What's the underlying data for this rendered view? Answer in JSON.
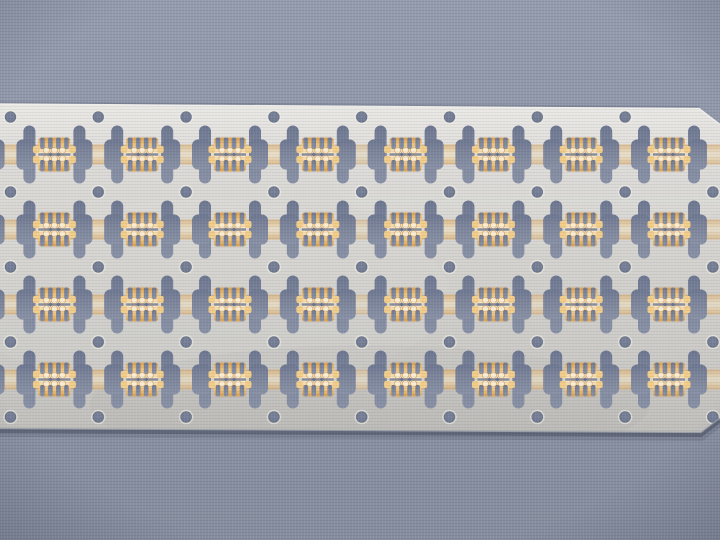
{
  "scene": {
    "description": "Photograph of an etched metal semiconductor lead frame strip with selective gold plating, lying on a blue-gray woven fabric background",
    "width": 720,
    "height": 540
  },
  "palette": {
    "bg_top": "#949cae",
    "bg_mid": "#8c94a6",
    "bg_bottom": "#858d9f",
    "metal_bright": "#eae9e5",
    "metal_hi": "#dedcd8",
    "metal_mid": "#d4d3cf",
    "metal_low": "#cac9c5",
    "metal_dark": "#c0bfbb",
    "edge_highlight": "#f2f1ed",
    "edge_shadow": "#343a4c",
    "cut_dark": "#6c7690",
    "cut_mid": "#7a8399",
    "cut_light": "#8891a5",
    "gold_deep": "#d89b4a",
    "gold_mid": "#eec584",
    "gold_pale": "#f6e7c6",
    "gold_hot": "#f9ecd2",
    "gold_tab": "#f2cd8a",
    "hole_ring": "#eef0ea"
  },
  "frame": {
    "strip": {
      "top_left_y": 104,
      "top_right_x": 699,
      "top_right_y": 108.5,
      "chamfer_top_right": [
        720,
        124.5
      ],
      "right_bottom": [
        720,
        418
      ],
      "chamfer_bottom_right": [
        701,
        432.5
      ],
      "bottom_left_y": 428.5
    },
    "holes": {
      "x0": 10.5,
      "y0": 117,
      "col_pitch": 87.8,
      "row_pitch": 75,
      "cols": 9,
      "rows": 5,
      "radius": 5.5,
      "skip": [
        [
          8,
          0
        ]
      ]
    },
    "unit_rows": 4,
    "bay_first": -1,
    "bay_last": 7,
    "slot": {
      "full_width": 19,
      "narrow_width": 12,
      "height": 58,
      "notch_band_height": 30,
      "radius": 6,
      "inner_offset": 19,
      "outer_offset": 38
    },
    "cluster": {
      "half_width": 16,
      "half_height": 17,
      "radius": 3,
      "finger_slot_w": 4.6,
      "finger_slot_h": 11.5,
      "finger_xs": [
        -12,
        -4,
        4,
        12
      ],
      "bulb_r": 3.1,
      "bulb_xs": [
        -8,
        0,
        8
      ],
      "bulb_dy": 4.2,
      "diamond_xs": [
        -4,
        4
      ],
      "diamond_size": 3.2,
      "tab_w": 5.5,
      "tab_h": 7,
      "tab_dy": 5,
      "slit_half": 1.3
    },
    "band": {
      "half_height": 10,
      "opacity": 0.62
    }
  }
}
